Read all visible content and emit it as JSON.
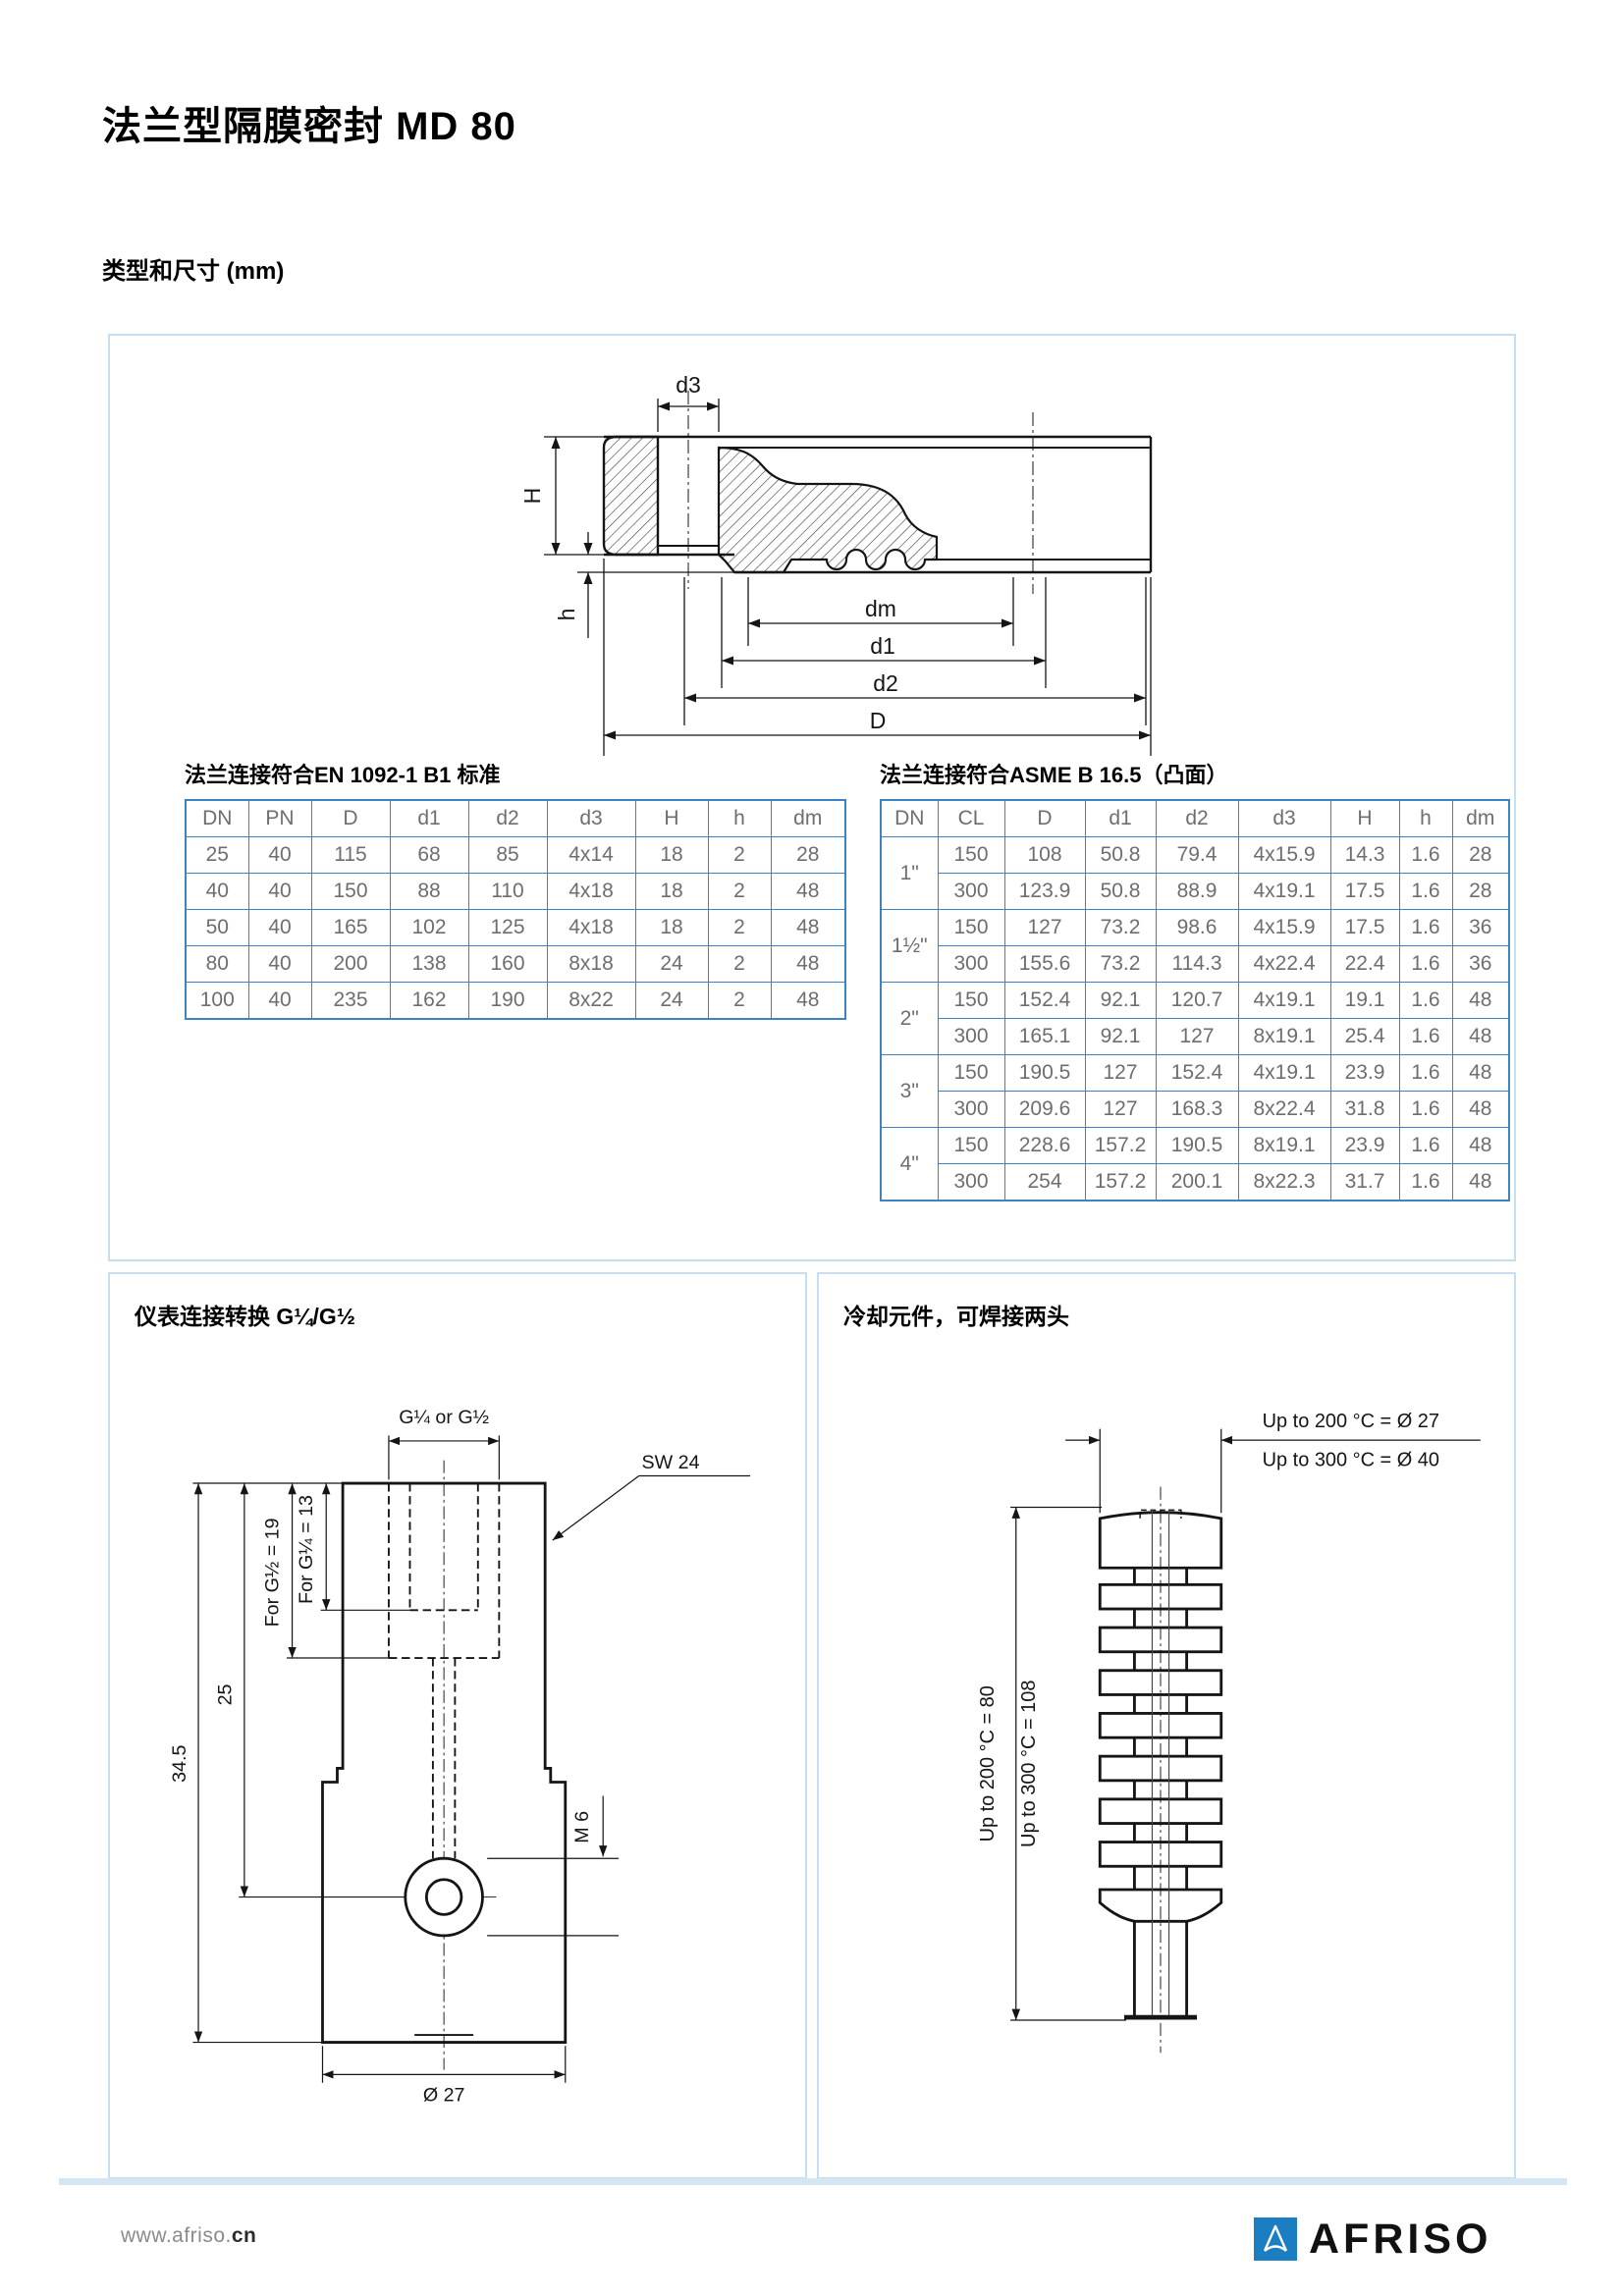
{
  "page": {
    "title": "法兰型隔膜密封 MD 80",
    "subtitle": "类型和尺寸 (mm)"
  },
  "drawing_flange": {
    "labels": {
      "d3": "d3",
      "H": "H",
      "h": "h",
      "dm": "dm",
      "d1": "d1",
      "d2": "d2",
      "D": "D"
    }
  },
  "tables": {
    "en": {
      "title": "法兰连接符合EN 1092-1 B1 标准",
      "headers": [
        "DN",
        "PN",
        "D",
        "d1",
        "d2",
        "d3",
        "H",
        "h",
        "dm"
      ],
      "rows": [
        [
          "25",
          "40",
          "115",
          "68",
          "85",
          "4x14",
          "18",
          "2",
          "28"
        ],
        [
          "40",
          "40",
          "150",
          "88",
          "110",
          "4x18",
          "18",
          "2",
          "48"
        ],
        [
          "50",
          "40",
          "165",
          "102",
          "125",
          "4x18",
          "18",
          "2",
          "48"
        ],
        [
          "80",
          "40",
          "200",
          "138",
          "160",
          "8x18",
          "24",
          "2",
          "48"
        ],
        [
          "100",
          "40",
          "235",
          "162",
          "190",
          "8x22",
          "24",
          "2",
          "48"
        ]
      ]
    },
    "asme": {
      "title": "法兰连接符合ASME B 16.5（凸面）",
      "headers": [
        "DN",
        "CL",
        "D",
        "d1",
        "d2",
        "d3",
        "H",
        "h",
        "dm"
      ],
      "groups": [
        {
          "dn": "1\"",
          "rows": [
            [
              "150",
              "108",
              "50.8",
              "79.4",
              "4x15.9",
              "14.3",
              "1.6",
              "28"
            ],
            [
              "300",
              "123.9",
              "50.8",
              "88.9",
              "4x19.1",
              "17.5",
              "1.6",
              "28"
            ]
          ]
        },
        {
          "dn": "1½\"",
          "rows": [
            [
              "150",
              "127",
              "73.2",
              "98.6",
              "4x15.9",
              "17.5",
              "1.6",
              "36"
            ],
            [
              "300",
              "155.6",
              "73.2",
              "114.3",
              "4x22.4",
              "22.4",
              "1.6",
              "36"
            ]
          ]
        },
        {
          "dn": "2\"",
          "rows": [
            [
              "150",
              "152.4",
              "92.1",
              "120.7",
              "4x19.1",
              "19.1",
              "1.6",
              "48"
            ],
            [
              "300",
              "165.1",
              "92.1",
              "127",
              "8x19.1",
              "25.4",
              "1.6",
              "48"
            ]
          ]
        },
        {
          "dn": "3\"",
          "rows": [
            [
              "150",
              "190.5",
              "127",
              "152.4",
              "4x19.1",
              "23.9",
              "1.6",
              "48"
            ],
            [
              "300",
              "209.6",
              "127",
              "168.3",
              "8x22.4",
              "31.8",
              "1.6",
              "48"
            ]
          ]
        },
        {
          "dn": "4\"",
          "rows": [
            [
              "150",
              "228.6",
              "157.2",
              "190.5",
              "8x19.1",
              "23.9",
              "1.6",
              "48"
            ],
            [
              "300",
              "254",
              "157.2",
              "200.1",
              "8x22.3",
              "31.7",
              "1.6",
              "48"
            ]
          ]
        }
      ]
    }
  },
  "panel_adapter": {
    "title": "仪表连接转换 G¼/G½",
    "labels": {
      "thread": "G¼ or G½",
      "wrench": "SW 24",
      "m6": "M 6",
      "dia": "Ø 27",
      "total_h": "34.5",
      "to_hole": "25",
      "g12_depth": "For G½ = 19",
      "g14_depth": "For G¼ = 13"
    }
  },
  "panel_cooling": {
    "title": "冷却元件，可焊接两头",
    "labels": {
      "dia200": "Up to 200 °C = Ø 27",
      "dia300": "Up to 300 °C = Ø 40",
      "len200": "Up to 200 °C =  80",
      "len300": "Up to 300 °C = 108"
    }
  },
  "footer": {
    "url_gray": "www.afriso.",
    "url_dark": "cn",
    "brand": "AFRISO"
  },
  "colors": {
    "table_border": "#3d82c2",
    "panel_border": "#c7ddf0",
    "accent_bar": "#d4e5f3",
    "logo_blue": "#1b7ec2",
    "table_text": "#6e6e6e"
  }
}
